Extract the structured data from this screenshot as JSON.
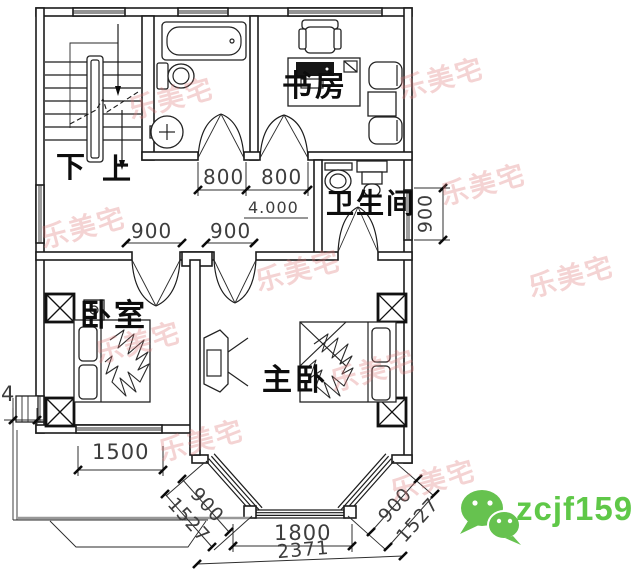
{
  "rooms": {
    "stair_down": "下",
    "stair_up": "上",
    "study": "书房",
    "toilet": "卫生间",
    "bedroom": "卧室",
    "master_bedroom": "主卧"
  },
  "dims": {
    "door1": "800",
    "door2": "800",
    "level": "4.000",
    "hall1": "900",
    "hall2": "900",
    "toilet_side": "900",
    "bedroom_win": "1500",
    "left_partial": "4",
    "bay_front": "1800",
    "bay_total": "2371",
    "bay_left_side": "900",
    "bay_left_depth": "1527",
    "bay_right_side": "900",
    "bay_right_depth": "1527"
  },
  "watermark": {
    "text": "乐美宅",
    "color": "#de7878"
  },
  "contact": {
    "wechat_id": "zcjf159",
    "color": "#5fc848"
  },
  "colors": {
    "line": "#1c1c1c",
    "porch_gray": "#989898",
    "wechat_green": "#66c24f"
  }
}
